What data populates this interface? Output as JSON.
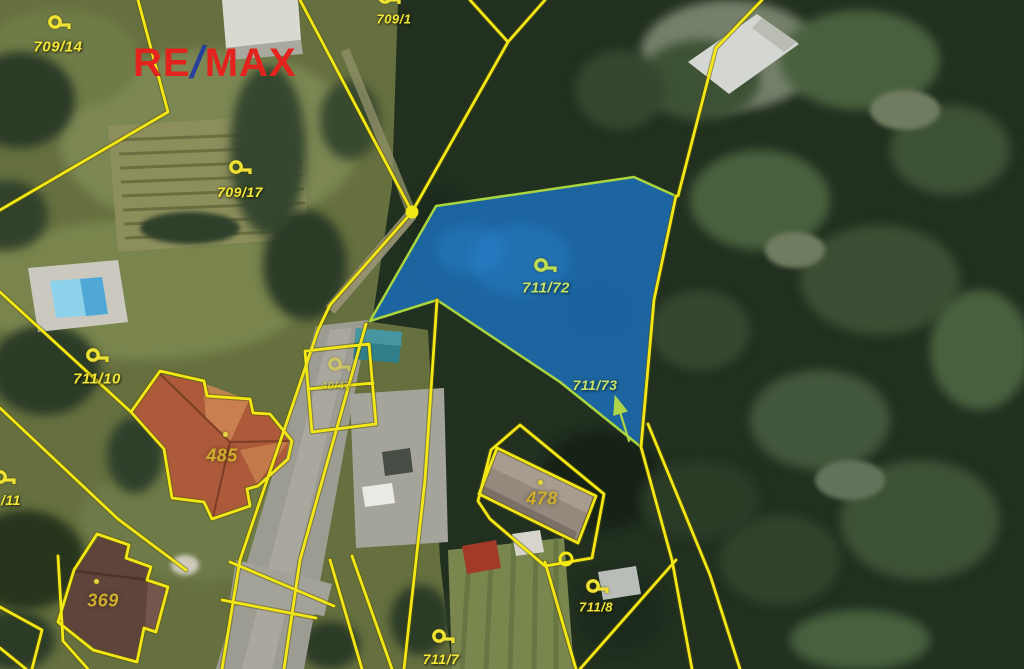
{
  "branding": {
    "re": "RE",
    "slash": "/",
    "max": "MAX"
  },
  "colors": {
    "boundary_yellow": "#f3e716",
    "highlight_fill": "#1c74c4",
    "highlight_border": "#a9d53e",
    "label_yellow": "#f1e63a",
    "label_green": "#c6e269",
    "building_label": "#cfae2e",
    "logo_red": "#e3231d",
    "logo_blue": "#27409b"
  },
  "parcels": {
    "p709_14": {
      "label": "709/14"
    },
    "p709_1": {
      "label": "709/1"
    },
    "p709_17": {
      "label": "709/17"
    },
    "p711_10": {
      "label": "711/10"
    },
    "p711_11": {
      "label": "/11"
    },
    "p711_72": {
      "label": "711/72"
    },
    "p711_73": {
      "label": "711/73"
    },
    "p711_8": {
      "label": "711/8"
    },
    "p711_7": {
      "label": "711/7"
    },
    "p40_47": {
      "label": "40/47"
    },
    "b485": {
      "label": "485"
    },
    "b478": {
      "label": "478"
    },
    "b369": {
      "label": "369"
    }
  }
}
